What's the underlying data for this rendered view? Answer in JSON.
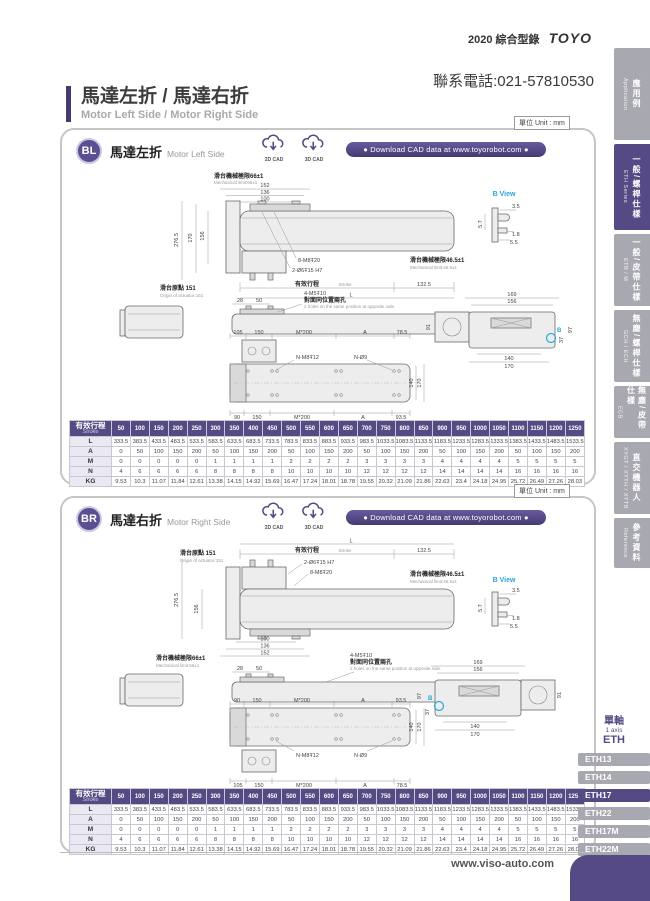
{
  "page": {
    "header": {
      "year": "2020",
      "catalog": "綜合型錄",
      "logo": "TOYO",
      "phone": "聯系電話:021-57810530"
    },
    "title_zh": "馬達左折 / 馬達右折",
    "title_en": "Motor Left Side / Motor Right Side",
    "unit_label": "單位 Unit : mm",
    "website": "www.viso-auto.com"
  },
  "sidebar": {
    "tabs": [
      {
        "zh": "應用例",
        "en": "Application",
        "active": false
      },
      {
        "zh": "一般/螺桿仕樣",
        "en": "ETH Series",
        "active": true
      },
      {
        "zh": "一般/皮帶仕樣",
        "en": "ETB / M",
        "active": false
      },
      {
        "zh": "無塵/螺桿仕樣",
        "en": "GCH / ECH",
        "active": false
      },
      {
        "zh": "無塵/皮帶仕樣",
        "en": "ECB",
        "active": false
      },
      {
        "zh": "直交機器人",
        "en": "XYGT / XYTH / XYTB",
        "active": false
      },
      {
        "zh": "參考資料",
        "en": "Reference",
        "active": false
      }
    ]
  },
  "sections": {
    "bl": {
      "badge": "BL",
      "title_zh": "馬達左折",
      "title_en": "Motor Left Side"
    },
    "br": {
      "badge": "BR",
      "title_zh": "馬達右折",
      "title_en": "Motor Right Side"
    },
    "cad": {
      "c2d": "2D CAD",
      "c3d": "3D CAD",
      "download": "● Download CAD data at www.toyorobot.com ●"
    }
  },
  "drawing": {
    "mech66_zh": "滑台機械極限66±1",
    "mech66_en": "Mechanical limit:66±1",
    "mech46_zh": "滑台機械極限46.5±1",
    "mech46_en": "Mechanical limit:46.5±1",
    "origin_zh": "滑台原點 151",
    "origin_en": "Origin of actuator:151",
    "stroke_zh": "有效行程",
    "stroke_en": "Stroke",
    "holes_8m8": "8-M8Ŧ20",
    "holes_2o6": "2-Ø6Ŧ15 H7",
    "holes_4m5": "4-M5Ŧ10",
    "holes_4m5_zh": "對面同位置兩孔",
    "holes_4m5_en": "2 holes on the same position at opposite side.",
    "n_m8": "N-M8Ŧ12",
    "n_o9": "N-Ø9",
    "bview": "B View",
    "dB": "B",
    "d152": "152",
    "d136": "136",
    "d100": "100",
    "d276_5": "276.5",
    "d170": "170",
    "d156": "156",
    "d132_5": "132.5",
    "dL": "L",
    "d28": "28",
    "d50": "50",
    "d3_5": "3.5",
    "d5_7": "5.7",
    "d1_8": "1.8",
    "d5_5": "5.5",
    "d169": "169",
    "d91": "91",
    "d97": "97",
    "d37": "37",
    "d140": "140",
    "d105": "105",
    "d150": "150",
    "m200": "M*200",
    "dA": "A",
    "d78_5": "78.5",
    "d90": "90",
    "d93_5": "93.5"
  },
  "stroke_table": {
    "header_zh": "有效行程",
    "header_en": "Stroke",
    "strokes": [
      "50",
      "100",
      "150",
      "200",
      "250",
      "300",
      "350",
      "400",
      "450",
      "500",
      "550",
      "600",
      "650",
      "700",
      "750",
      "800",
      "850",
      "900",
      "950",
      "1000",
      "1050",
      "1100",
      "1150",
      "1200",
      "1250"
    ],
    "rows": [
      {
        "label": "L",
        "values": [
          "333.5",
          "383.5",
          "433.5",
          "483.5",
          "533.5",
          "583.5",
          "633.5",
          "683.5",
          "733.5",
          "783.5",
          "833.5",
          "883.5",
          "933.5",
          "983.5",
          "1033.5",
          "1083.5",
          "1133.5",
          "1183.5",
          "1233.5",
          "1283.5",
          "1333.5",
          "1383.5",
          "1433.5",
          "1483.5",
          "1533.5"
        ]
      },
      {
        "label": "A",
        "values": [
          "0",
          "50",
          "100",
          "150",
          "200",
          "50",
          "100",
          "150",
          "200",
          "50",
          "100",
          "150",
          "200",
          "50",
          "100",
          "150",
          "200",
          "50",
          "100",
          "150",
          "200",
          "50",
          "100",
          "150",
          "200"
        ]
      },
      {
        "label": "M",
        "values": [
          "0",
          "0",
          "0",
          "0",
          "0",
          "1",
          "1",
          "1",
          "1",
          "2",
          "2",
          "2",
          "2",
          "3",
          "3",
          "3",
          "3",
          "4",
          "4",
          "4",
          "4",
          "5",
          "5",
          "5",
          "5"
        ]
      },
      {
        "label": "N",
        "values": [
          "4",
          "6",
          "6",
          "6",
          "6",
          "8",
          "8",
          "8",
          "8",
          "10",
          "10",
          "10",
          "10",
          "12",
          "12",
          "12",
          "12",
          "14",
          "14",
          "14",
          "14",
          "16",
          "16",
          "16",
          "16"
        ]
      },
      {
        "label": "KG",
        "values": [
          "9.53",
          "10.3",
          "11.07",
          "11.84",
          "12.61",
          "13.38",
          "14.15",
          "14.92",
          "15.69",
          "16.47",
          "17.24",
          "18.01",
          "18.78",
          "19.55",
          "20.32",
          "21.09",
          "21.86",
          "22.63",
          "23.4",
          "24.18",
          "24.95",
          "25.72",
          "26.49",
          "27.26",
          "28.03"
        ]
      }
    ]
  },
  "model_nav": {
    "group_zh": "單軸",
    "group_en": "1 axis",
    "series": "ETH",
    "items": [
      {
        "label": "ETH13",
        "active": false
      },
      {
        "label": "ETH14",
        "active": false
      },
      {
        "label": "ETH17",
        "active": true
      },
      {
        "label": "ETH22",
        "active": false
      },
      {
        "label": "ETH17M",
        "active": false
      },
      {
        "label": "ETH22M",
        "active": false
      }
    ]
  },
  "colors": {
    "accent": "#564a84",
    "tab_gray": "#a8a8b0",
    "bview_cyan": "#2aa7dc"
  }
}
